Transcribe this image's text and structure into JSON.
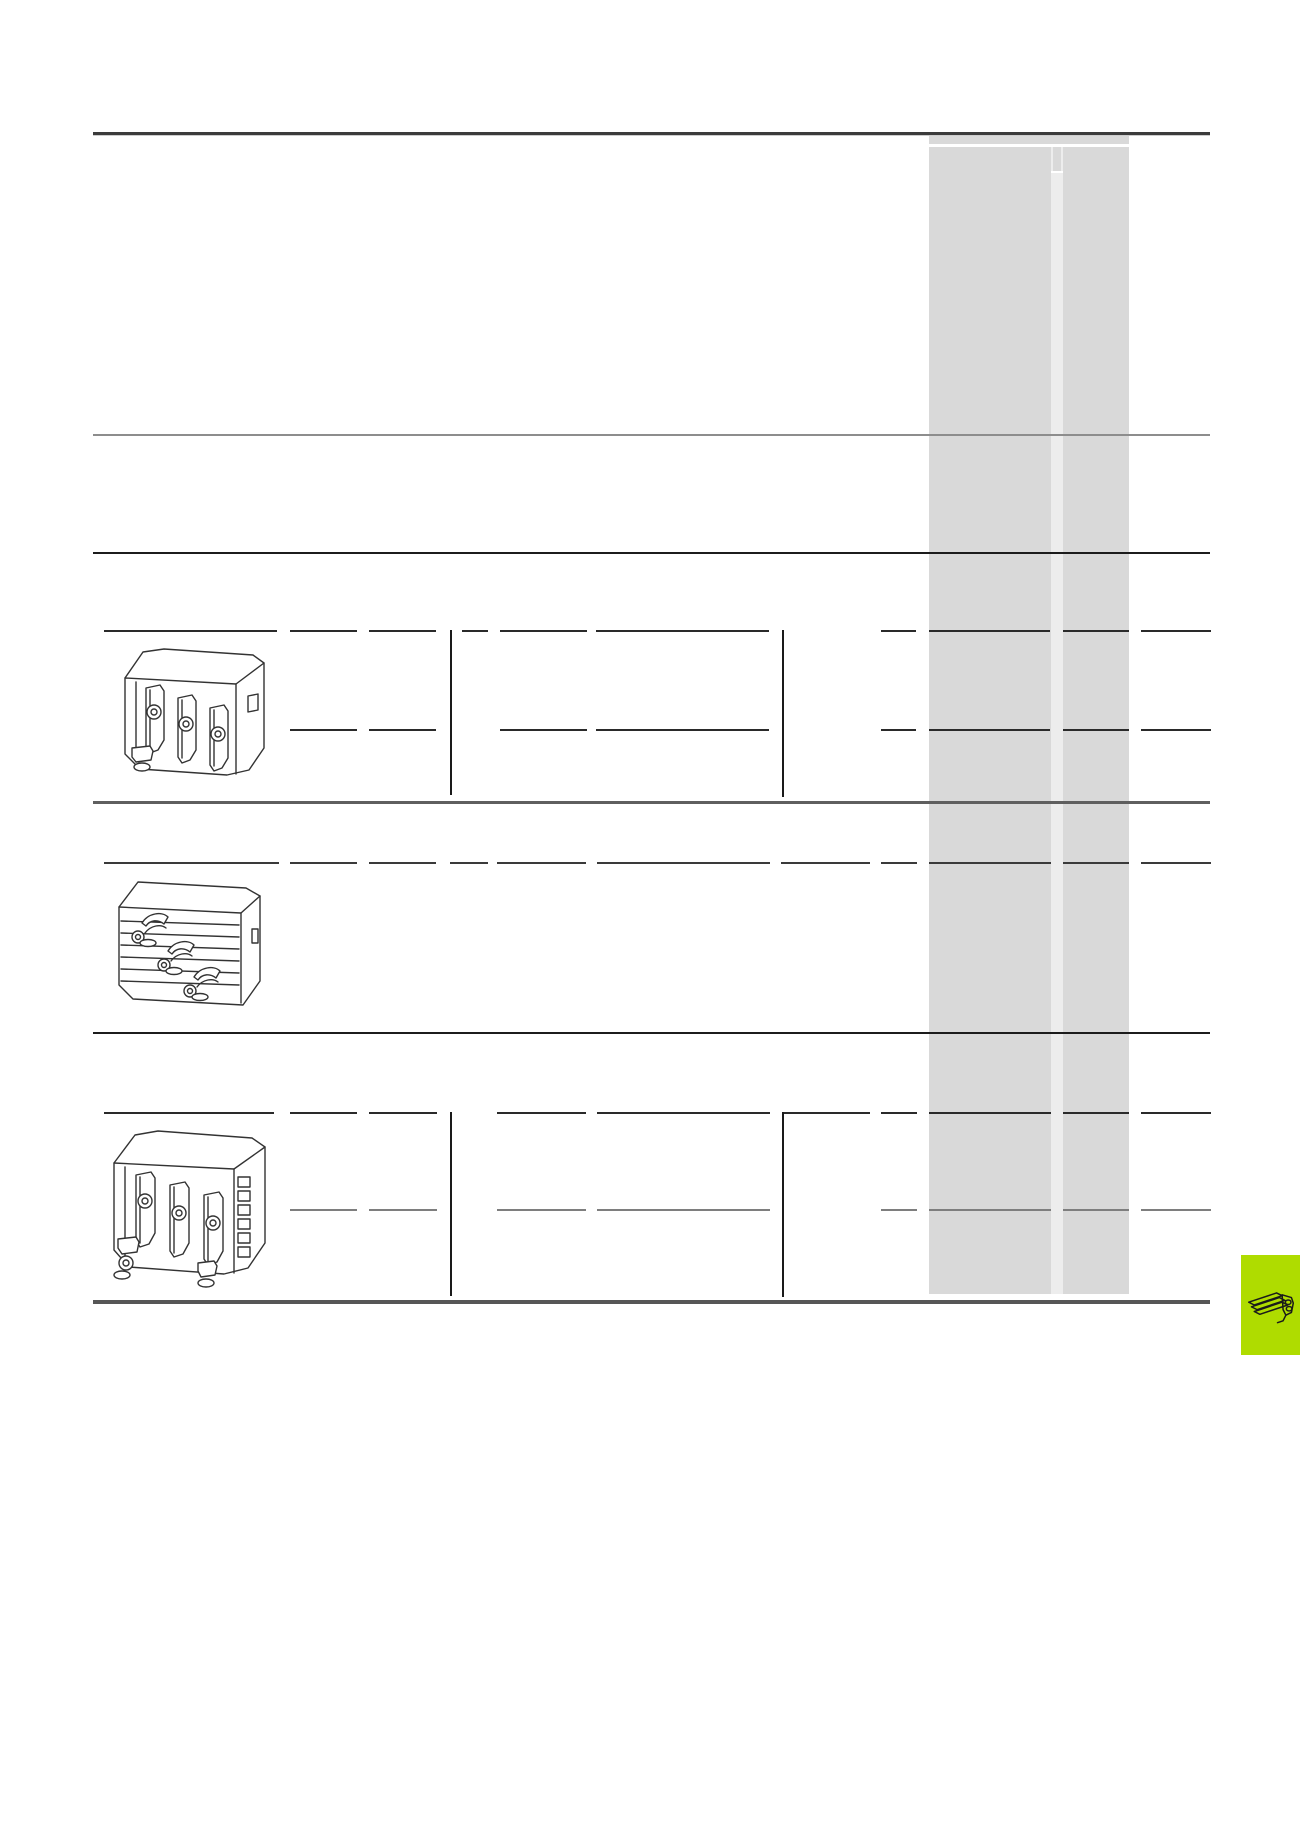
{
  "document": {
    "kind": "catalog-table-page",
    "visible_text": [],
    "description_of_content": "empty catalog order-table template with three product rows, highlighted price column and chapter tab"
  },
  "colors": {
    "page_bg": "#ffffff",
    "gray_column": "#d9d9d9",
    "gray_strip": "#ededed",
    "white_divider": "#ffffff",
    "rule_dark": "#3b3b3b",
    "rule_shadow": "#cccccc",
    "rule_gray": "#8d8d8d",
    "rule_black": "#1c1c1c",
    "rule_mid": "#5f5f5f",
    "rule_bottom": "#565656",
    "dash_black": "#2a2a2a",
    "dash_gray": "#7e7e7e",
    "vbar_black": "#1a1a1a",
    "green_tab": "#afdc00",
    "drawing_stroke": "#333333"
  },
  "layout": {
    "rules": [
      {
        "x1": 93,
        "x2": 1210,
        "y": 132,
        "t": 3,
        "color": "#3b3b3b"
      },
      {
        "x1": 93,
        "x2": 1210,
        "y": 135,
        "t": 1,
        "color": "#cccccc"
      },
      {
        "x1": 93,
        "x2": 1210,
        "y": 434,
        "t": 2,
        "color": "#8d8d8d"
      },
      {
        "x1": 93,
        "x2": 1210,
        "y": 552,
        "t": 2,
        "color": "#1c1c1c"
      },
      {
        "x1": 93,
        "x2": 1210,
        "y": 801,
        "t": 3,
        "color": "#5f5f5f"
      },
      {
        "x1": 93,
        "x2": 1210,
        "y": 1032,
        "t": 2,
        "color": "#1c1c1c"
      },
      {
        "x1": 93,
        "x2": 1210,
        "y": 1300,
        "t": 4,
        "color": "#565656"
      }
    ],
    "gray_column": {
      "main": {
        "x": 929,
        "y": 135,
        "w": 200,
        "h": 1159,
        "fill": "#d9d9d9"
      },
      "header_line": {
        "x": 929,
        "y": 144,
        "w": 200,
        "h": 3,
        "fill": "#ffffff"
      },
      "strip": {
        "x": 1051,
        "y": 147,
        "w": 12,
        "h": 1147,
        "fill": "#ededed"
      },
      "strip_cell": {
        "x": 1053,
        "y": 147,
        "w": 8,
        "h": 24,
        "fill": "#d9d9d9"
      },
      "cell_bottom": {
        "x": 1051,
        "y": 171,
        "w": 12,
        "h": 2,
        "fill": "#ffffff"
      }
    },
    "dash_lines": [
      {
        "y": 630,
        "t": 2,
        "color": "#2a2a2a",
        "segments": [
          [
            104,
            277
          ],
          [
            290,
            357
          ],
          [
            369,
            436
          ],
          [
            462,
            488
          ],
          [
            500,
            587
          ],
          [
            596,
            769
          ],
          [
            881,
            916
          ],
          [
            929,
            1050
          ],
          [
            1063,
            1129
          ],
          [
            1141,
            1211
          ]
        ]
      },
      {
        "y": 729,
        "t": 2,
        "color": "#2a2a2a",
        "segments": [
          [
            290,
            357
          ],
          [
            369,
            436
          ],
          [
            500,
            587
          ],
          [
            596,
            769
          ],
          [
            881,
            916
          ],
          [
            929,
            1050
          ],
          [
            1063,
            1129
          ],
          [
            1141,
            1211
          ]
        ]
      },
      {
        "y": 862,
        "t": 2,
        "color": "#3a3a3a",
        "segments": [
          [
            104,
            279
          ],
          [
            290,
            357
          ],
          [
            369,
            436
          ],
          [
            450,
            488
          ],
          [
            497,
            586
          ],
          [
            597,
            770
          ],
          [
            781,
            870
          ],
          [
            881,
            917
          ],
          [
            929,
            1051
          ],
          [
            1063,
            1129
          ],
          [
            1141,
            1211
          ]
        ]
      },
      {
        "y": 1112,
        "t": 2,
        "color": "#2a2a2a",
        "segments": [
          [
            104,
            274
          ],
          [
            290,
            357
          ],
          [
            369,
            437
          ],
          [
            497,
            586
          ],
          [
            597,
            770
          ],
          [
            783,
            870
          ],
          [
            881,
            917
          ],
          [
            929,
            1051
          ],
          [
            1063,
            1129
          ],
          [
            1141,
            1211
          ]
        ]
      },
      {
        "y": 1209,
        "t": 2,
        "color": "#7e7e7e",
        "segments": [
          [
            290,
            357
          ],
          [
            369,
            437
          ],
          [
            497,
            586
          ],
          [
            597,
            770
          ],
          [
            881,
            917
          ],
          [
            929,
            1051
          ],
          [
            1063,
            1129
          ],
          [
            1141,
            1211
          ]
        ]
      }
    ],
    "vbars": [
      {
        "x": 450,
        "y1": 630,
        "y2": 795
      },
      {
        "x": 782,
        "y1": 630,
        "y2": 797
      },
      {
        "x": 450,
        "y1": 1112,
        "y2": 1296
      },
      {
        "x": 782,
        "y1": 1112,
        "y2": 1297
      }
    ],
    "images": [
      {
        "x": 112,
        "y": 636,
        "w": 166,
        "h": 160
      },
      {
        "x": 108,
        "y": 867,
        "w": 166,
        "h": 160
      },
      {
        "x": 102,
        "y": 1117,
        "w": 180,
        "h": 178
      }
    ],
    "green_tab": {
      "x": 1241,
      "y": 1255,
      "w": 59,
      "h": 100,
      "fill": "#afdc00"
    }
  },
  "icons": [
    {
      "name": "busbar-adapter-drawing-row1",
      "meaning": "isometric line drawing of 3-phase busbar device adapter"
    },
    {
      "name": "busbar-terminal-drawing-row2",
      "meaning": "isometric line drawing of busbar system with three feeder clamp terminals"
    },
    {
      "name": "busbar-adapter-drawing-row3",
      "meaning": "isometric line drawing of large 3-phase busbar device adapter"
    },
    {
      "name": "chapter-tab-adapter-icon",
      "meaning": "small busbar adapter glyph on green chapter tab"
    }
  ]
}
